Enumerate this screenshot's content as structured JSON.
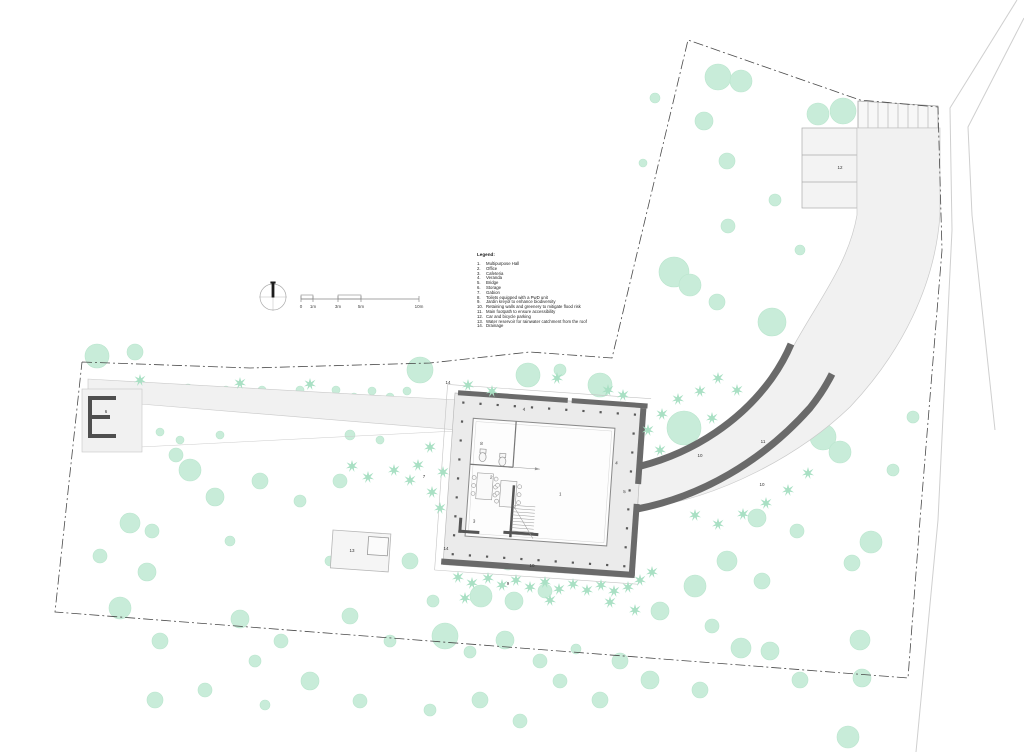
{
  "sheet": {
    "type": "architectural site plan",
    "legend": {
      "title": "Legend:",
      "items": [
        "Multipurpose Hall",
        "Office",
        "Cafeteria",
        "Veranda",
        "Bridge",
        "Storage",
        "Gabion",
        "Toilets equipped with a PwD unit",
        "Jardin kreyòl to enhance biodiversity",
        "Retaining walls and greenery to mitigate flood risk",
        "Main footpath to ensure accessibility",
        "Car and bicycle parking",
        "Water reservoir for rainwater catchment from the roof",
        "Drainage"
      ]
    },
    "scale_bar": {
      "labels": [
        "0",
        "1m",
        "3m",
        "5m",
        "10m"
      ],
      "tick_x": [
        301,
        313,
        338,
        361,
        419
      ]
    },
    "colors": {
      "tree": "#c8ecd9",
      "tree_edge": "#b9e5cd",
      "star_plant": "#a9e0c4",
      "wall_dark": "#6a6a6a",
      "wall_black": "#4f4f4f",
      "veranda": "#ebebeb",
      "pavement": "#f1f1f1",
      "boundary": "#4a4a4a",
      "label": "#333333"
    },
    "plan_labels": [
      {
        "n": "6",
        "x": 106,
        "y": 413
      },
      {
        "n": "7",
        "x": 424,
        "y": 478
      },
      {
        "n": "9",
        "x": 508,
        "y": 585
      },
      {
        "n": "10",
        "x": 700,
        "y": 457
      },
      {
        "n": "10",
        "x": 762,
        "y": 486
      },
      {
        "n": "10",
        "x": 532,
        "y": 567
      },
      {
        "n": "11",
        "x": 763,
        "y": 443
      },
      {
        "n": "12",
        "x": 840,
        "y": 169
      },
      {
        "n": "13",
        "x": 352,
        "y": 552
      },
      {
        "n": "14",
        "x": 448,
        "y": 384
      },
      {
        "n": "14",
        "x": 446,
        "y": 550
      }
    ],
    "building_labels": [
      {
        "n": "8",
        "x": 30,
        "y": 50
      },
      {
        "n": "2",
        "x": 42,
        "y": 83
      },
      {
        "n": "3",
        "x": 28,
        "y": 128
      },
      {
        "n": "1",
        "x": 112,
        "y": 95
      },
      {
        "n": "4",
        "x": 70,
        "y": 13
      },
      {
        "n": "4",
        "x": 166,
        "y": 60
      },
      {
        "n": "5",
        "x": 176,
        "y": 88
      }
    ],
    "trees": [
      [
        718,
        77,
        13
      ],
      [
        741,
        81,
        11
      ],
      [
        704,
        121,
        9
      ],
      [
        727,
        161,
        8
      ],
      [
        728,
        226,
        7
      ],
      [
        674,
        272,
        15
      ],
      [
        690,
        285,
        11
      ],
      [
        717,
        302,
        8
      ],
      [
        772,
        322,
        14
      ],
      [
        867,
        311,
        8
      ],
      [
        894,
        262,
        7
      ],
      [
        818,
        114,
        11
      ],
      [
        843,
        111,
        13
      ],
      [
        896,
        319,
        6
      ],
      [
        913,
        417,
        6
      ],
      [
        655,
        98,
        5
      ],
      [
        643,
        163,
        4
      ],
      [
        775,
        200,
        6
      ],
      [
        800,
        250,
        5
      ],
      [
        684,
        428,
        17
      ],
      [
        823,
        437,
        13
      ],
      [
        840,
        452,
        11
      ],
      [
        757,
        518,
        9
      ],
      [
        797,
        531,
        7
      ],
      [
        727,
        561,
        10
      ],
      [
        762,
        581,
        8
      ],
      [
        871,
        542,
        11
      ],
      [
        852,
        563,
        8
      ],
      [
        893,
        470,
        6
      ],
      [
        860,
        640,
        10
      ],
      [
        862,
        678,
        9
      ],
      [
        848,
        737,
        11
      ],
      [
        800,
        680,
        8
      ],
      [
        770,
        651,
        9
      ],
      [
        741,
        648,
        10
      ],
      [
        700,
        690,
        8
      ],
      [
        712,
        626,
        7
      ],
      [
        695,
        586,
        11
      ],
      [
        660,
        611,
        9
      ],
      [
        650,
        680,
        9
      ],
      [
        620,
        661,
        8
      ],
      [
        600,
        700,
        8
      ],
      [
        560,
        681,
        7
      ],
      [
        576,
        649,
        5
      ],
      [
        505,
        640,
        9
      ],
      [
        540,
        661,
        7
      ],
      [
        520,
        721,
        7
      ],
      [
        480,
        700,
        8
      ],
      [
        445,
        636,
        13
      ],
      [
        430,
        710,
        6
      ],
      [
        433,
        601,
        6
      ],
      [
        470,
        652,
        6
      ],
      [
        481,
        596,
        11
      ],
      [
        514,
        601,
        9
      ],
      [
        545,
        591,
        7
      ],
      [
        508,
        562,
        8
      ],
      [
        240,
        619,
        9
      ],
      [
        281,
        641,
        7
      ],
      [
        350,
        616,
        8
      ],
      [
        390,
        641,
        6
      ],
      [
        310,
        681,
        9
      ],
      [
        360,
        701,
        7
      ],
      [
        255,
        661,
        6
      ],
      [
        160,
        641,
        8
      ],
      [
        120,
        608,
        11
      ],
      [
        100,
        556,
        7
      ],
      [
        130,
        523,
        10
      ],
      [
        152,
        531,
        7
      ],
      [
        147,
        572,
        9
      ],
      [
        190,
        470,
        11
      ],
      [
        215,
        497,
        9
      ],
      [
        176,
        455,
        7
      ],
      [
        260,
        481,
        8
      ],
      [
        300,
        501,
        6
      ],
      [
        340,
        481,
        7
      ],
      [
        230,
        541,
        5
      ],
      [
        370,
        541,
        6
      ],
      [
        410,
        561,
        8
      ],
      [
        330,
        561,
        5
      ],
      [
        205,
        690,
        7
      ],
      [
        155,
        700,
        8
      ],
      [
        265,
        705,
        5
      ],
      [
        97,
        356,
        12
      ],
      [
        135,
        352,
        8
      ],
      [
        152,
        390,
        4
      ],
      [
        170,
        398,
        4
      ],
      [
        188,
        389,
        5
      ],
      [
        207,
        398,
        4
      ],
      [
        226,
        390,
        4
      ],
      [
        244,
        398,
        4
      ],
      [
        262,
        390,
        4
      ],
      [
        281,
        397,
        5
      ],
      [
        300,
        390,
        4
      ],
      [
        318,
        397,
        4
      ],
      [
        336,
        390,
        4
      ],
      [
        354,
        397,
        4
      ],
      [
        372,
        391,
        4
      ],
      [
        390,
        397,
        4
      ],
      [
        407,
        391,
        4
      ],
      [
        160,
        432,
        4
      ],
      [
        180,
        440,
        4
      ],
      [
        220,
        435,
        4
      ],
      [
        350,
        435,
        5
      ],
      [
        380,
        440,
        4
      ],
      [
        420,
        370,
        13
      ],
      [
        528,
        375,
        12
      ],
      [
        600,
        385,
        12
      ],
      [
        560,
        370,
        6
      ]
    ],
    "star_plants": [
      [
        458,
        577
      ],
      [
        472,
        583
      ],
      [
        488,
        578
      ],
      [
        502,
        585
      ],
      [
        516,
        580
      ],
      [
        530,
        587
      ],
      [
        545,
        582
      ],
      [
        559,
        589
      ],
      [
        573,
        584
      ],
      [
        587,
        590
      ],
      [
        601,
        585
      ],
      [
        614,
        591
      ],
      [
        628,
        587
      ],
      [
        640,
        580
      ],
      [
        652,
        572
      ],
      [
        465,
        598
      ],
      [
        550,
        600
      ],
      [
        610,
        602
      ],
      [
        635,
        610
      ],
      [
        648,
        430
      ],
      [
        662,
        414
      ],
      [
        678,
        399
      ],
      [
        700,
        391
      ],
      [
        718,
        378
      ],
      [
        737,
        390
      ],
      [
        712,
        418
      ],
      [
        660,
        450
      ],
      [
        695,
        515
      ],
      [
        718,
        524
      ],
      [
        743,
        514
      ],
      [
        766,
        503
      ],
      [
        788,
        490
      ],
      [
        808,
        473
      ],
      [
        430,
        447
      ],
      [
        443,
        472
      ],
      [
        432,
        492
      ],
      [
        418,
        465
      ],
      [
        352,
        466
      ],
      [
        368,
        477
      ],
      [
        394,
        470
      ],
      [
        410,
        480
      ],
      [
        440,
        508
      ],
      [
        468,
        385
      ],
      [
        492,
        391
      ],
      [
        557,
        378
      ],
      [
        608,
        390
      ],
      [
        623,
        395
      ],
      [
        140,
        380
      ],
      [
        240,
        383
      ],
      [
        310,
        384
      ]
    ]
  }
}
